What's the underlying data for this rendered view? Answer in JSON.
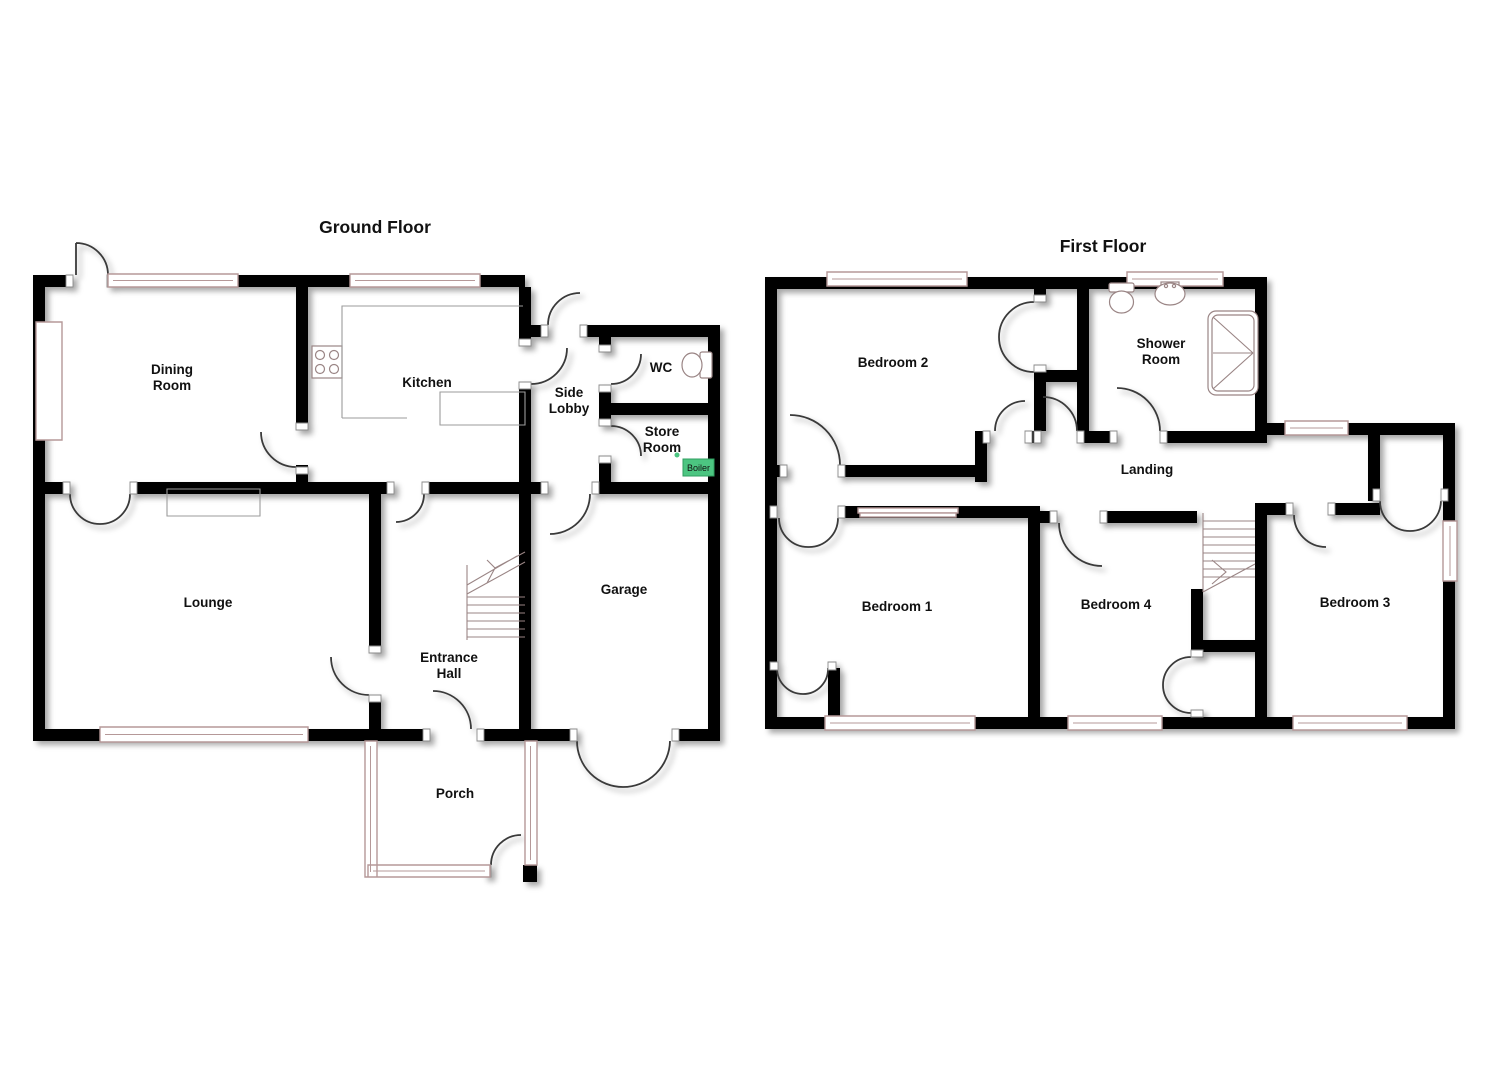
{
  "document": {
    "type": "floorplan",
    "background": "#ffffff"
  },
  "ground_floor": {
    "title": "Ground Floor",
    "rooms": {
      "dining_room": {
        "line1": "Dining",
        "line2": "Room"
      },
      "kitchen": {
        "label": "Kitchen"
      },
      "side_lobby": {
        "line1": "Side",
        "line2": "Lobby"
      },
      "wc": {
        "label": "WC"
      },
      "store_room": {
        "line1": "Store",
        "line2": "Room"
      },
      "boiler": {
        "label": "Boiler"
      },
      "lounge": {
        "label": "Lounge"
      },
      "entrance_hall": {
        "line1": "Entrance",
        "line2": "Hall"
      },
      "garage": {
        "label": "Garage"
      },
      "porch": {
        "label": "Porch"
      }
    }
  },
  "first_floor": {
    "title": "First Floor",
    "rooms": {
      "bedroom_2": {
        "label": "Bedroom 2"
      },
      "shower_room": {
        "line1": "Shower",
        "line2": "Room"
      },
      "landing": {
        "label": "Landing"
      },
      "bedroom_1": {
        "label": "Bedroom 1"
      },
      "bedroom_4": {
        "label": "Bedroom 4"
      },
      "bedroom_3": {
        "label": "Bedroom 3"
      }
    }
  },
  "colors": {
    "wall": "#000000",
    "window_frame": "#b59898",
    "door_arc": "#3a3a3a",
    "fixture_line": "#9a8585",
    "boiler_fill": "#4cc581",
    "boiler_border": "#2f9e60",
    "label": "#111111"
  }
}
